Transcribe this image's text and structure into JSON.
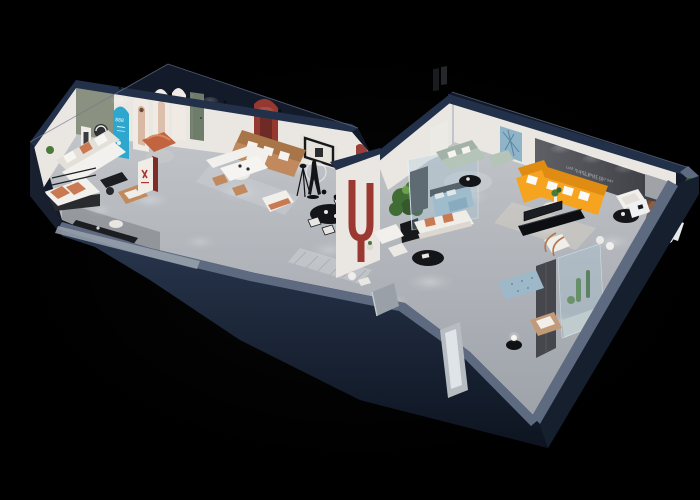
{
  "meta": {
    "type": "3d-isometric-floorplan-render",
    "description": "Dollhouse-style 3D cutaway render of a furniture showroom apartment on a black background, viewed isometrically. Dark navy exterior walls are cut low revealing furnished rooms lit by ceiling downlights.",
    "canvas": {
      "width": 700,
      "height": 500
    }
  },
  "palette": {
    "background": "#000000",
    "wallNavy": "#22304a",
    "wallNavyDark": "#131b2a",
    "wallCap": "#5d6a80",
    "wallCapLight": "#99a1ad",
    "floor": "#b4b8be",
    "interiorWhite": "#eae7e2",
    "accentGreenWall": "#8a9180",
    "accentDarkWall": "#4b4d53",
    "tealPoster": "#2ea7cf",
    "redAccent": "#95382f",
    "orangeSofa": "#f6a41f",
    "terracotta": "#c97a52",
    "sageSofa": "#b5c4b8",
    "tanLeather": "#c08a5e",
    "copper": "#c1643f",
    "plantGreen": "#4a7a3a",
    "furnitureBlack": "#141519",
    "glassTint": "rgba(165,202,218,0.28)",
    "blueBed": "#9db8c8",
    "artBlue": "#8fb3c7"
  },
  "scene": {
    "slogan": {
      "line1": "LIFE IS NOT WHAT YOU SAY",
      "line2": "IT'S WHAT YOU DO"
    },
    "poster_glyphs": "888",
    "rooms": [
      "green-accent-lounge",
      "arched-gallery-corridor",
      "daybed-room",
      "dining-nook",
      "black-dining-area",
      "red-u-hall",
      "glass-bedroom-display",
      "sage-den",
      "orange-sofa-showroom",
      "glass-cactus-display",
      "corner-reading-nook"
    ],
    "objects": [
      "white-sofa",
      "daybed",
      "media-console",
      "copper-ottoman",
      "tan-leather-sofa",
      "dining-banquette",
      "brown-dining-chairs",
      "mannequin-ring-sculpture",
      "tripod-lamp",
      "black-dining-table",
      "red-u-arch-column",
      "large-potted-plant",
      "white-armchairs",
      "black-oval-coffee-tables",
      "blue-display-bed",
      "sage-sectional",
      "blue-abstract-art",
      "orange-l-sectional",
      "tv-console",
      "teddy-bear-figure",
      "white-desk-set",
      "bronze-arm-lounge-chair",
      "glass-cactus-case",
      "gray-wardrobe",
      "blue-tufted-bench",
      "tan-armchair",
      "sphere-table-lamp",
      "teal-arch-poster",
      "white-arch-posters",
      "green-door",
      "red-arch-niche",
      "floor-mirror-panel"
    ]
  }
}
